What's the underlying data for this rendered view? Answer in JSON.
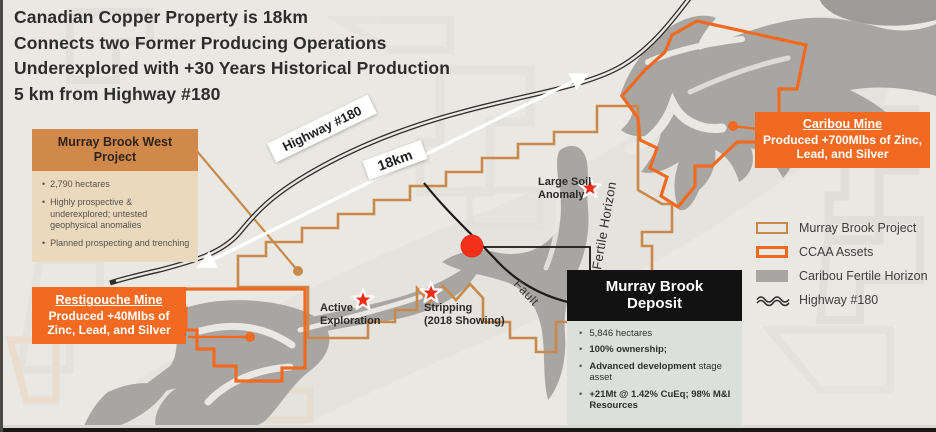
{
  "slide": {
    "title_lines": [
      "Canadian Copper Property is 18km",
      "Connects two Former Producing Operations",
      "Underexplored with +30 Years Historical Production",
      "5 km from Highway #180"
    ]
  },
  "callouts": {
    "murray_brook_west": {
      "title": "Murray Brook West Project",
      "bullets": [
        "2,790 hectares",
        "Highly prospective & underexplored; untested geophysical anomalies",
        "Planned prospecting and trenching"
      ]
    },
    "caribou_mine": {
      "title": "Caribou Mine",
      "subtitle": "Produced +700Mlbs of Zinc, Lead, and Silver"
    },
    "restigouche_mine": {
      "title": "Restigouche Mine",
      "subtitle": "Produced +40Mlbs of Zinc, Lead, and Silver"
    },
    "murray_brook_deposit": {
      "title_line1": "Murray Brook",
      "title_line2": "Deposit",
      "bullets": [
        {
          "segments": [
            {
              "text": "5,846 hectares",
              "bold": false
            }
          ]
        },
        {
          "segments": [
            {
              "text": "100% ownership;",
              "bold": true
            }
          ]
        },
        {
          "segments": [
            {
              "text": "Advanced development",
              "bold": true
            },
            {
              "text": " stage asset",
              "bold": false
            }
          ]
        },
        {
          "segments": [
            {
              "text": "+21Mt @ 1.42% CuEq; 98% M&I Resources",
              "bold": true
            }
          ]
        }
      ]
    }
  },
  "map_labels": {
    "highway": "Highway #180",
    "distance": "18km",
    "large_soil_anomaly": "Large Soil\nAnomaly",
    "active_exploration": "Active\nExploration",
    "stripping": "Stripping\n(2018 Showing)",
    "fault": "Fault",
    "fertile_horizon": "Fertile Horizon"
  },
  "legend": {
    "items": [
      {
        "label": "Murray Brook Project",
        "swatch": "tan-outline"
      },
      {
        "label": "CCAA Assets",
        "swatch": "orange-outline"
      },
      {
        "label": "Caribou Fertile Horizon",
        "swatch": "gray-fill"
      },
      {
        "label": "Highway #180",
        "swatch": "highway-line"
      }
    ]
  },
  "colors": {
    "background": "#EAE8E3",
    "accent_orange": "#F26A21",
    "tan_boundary": "#C9894B",
    "tan_header": "#D0894B",
    "tan_body": "#EBD9BE",
    "gray_horizon": "#A8A6A3",
    "marker_red": "#F0301C",
    "deposit_header": "#121212",
    "deposit_body": "#DBE0DC",
    "text_dark": "#2D2D2D"
  }
}
